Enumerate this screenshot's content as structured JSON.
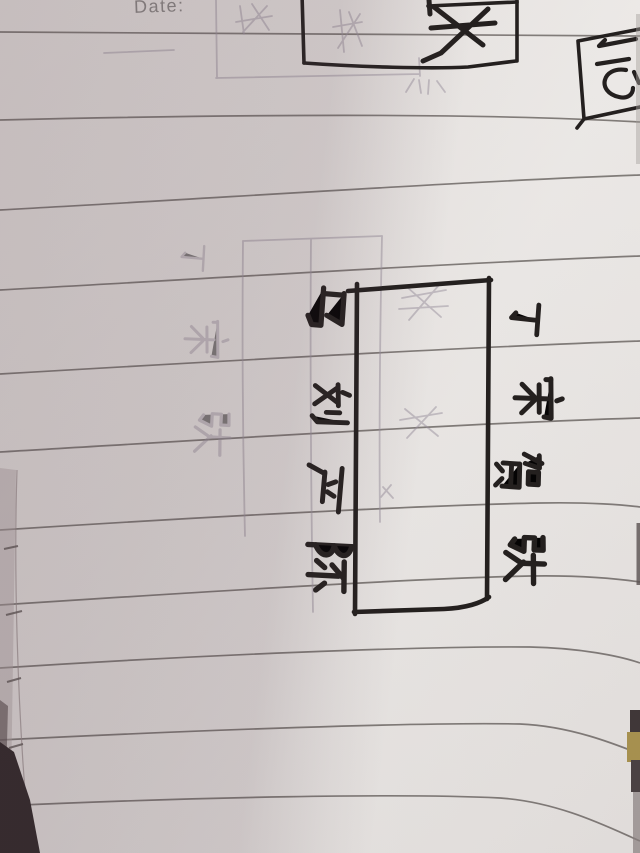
{
  "page": {
    "date_label": "Date:"
  },
  "diagram": {
    "right_names": [
      "丁",
      "宋",
      "贺",
      "张"
    ],
    "left_names": [
      "马",
      "刘",
      "严",
      "陈"
    ]
  },
  "colors": {
    "ink": "#211e1c",
    "paper_light": "#f1efec",
    "paper_shadow": "#d6cfd1",
    "ruled_line": "#6f6a66",
    "pencil_ghost": "#9d95a2",
    "dark_corner": "#2e2627",
    "edge_yellow": "#ad9750"
  }
}
